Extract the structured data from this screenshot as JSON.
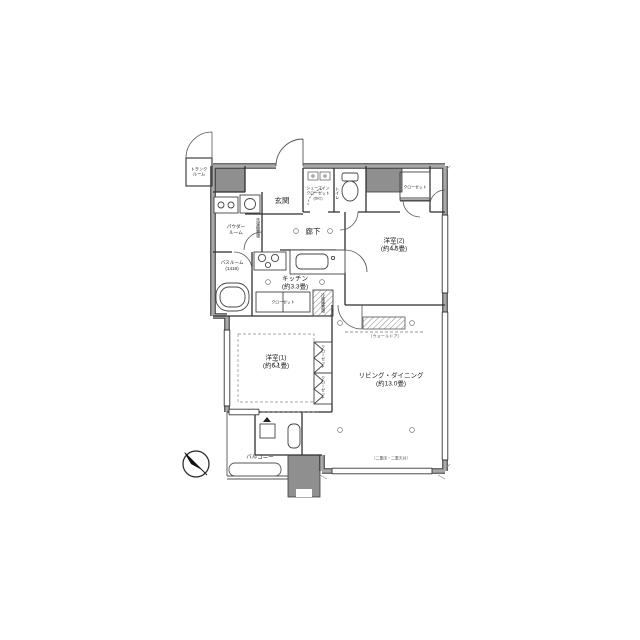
{
  "title": "マンション間取り図",
  "colors": {
    "wall_gray": "#9a9a9a",
    "wall_dark": "#3c3c3c",
    "meter_box_fill": "#8f8f8f",
    "text": "#1e1e1e",
    "note_text": "#5a5a5a",
    "background": "#ffffff"
  },
  "labels": {
    "trunk": "トランク\nルーム",
    "entrance": "玄関",
    "shoes_closet": "シューズイン\nクローゼット\n(SIC)",
    "toilet": "トイレ",
    "hallway": "廊下",
    "powder": "パウダー\nルーム",
    "washer": "洗濯機置場",
    "bath": "バスルーム\n(1418)",
    "kitchen": "キッチン\n(約3.3畳)",
    "kitchen_closet": "クローゼット",
    "fridge": "冷蔵庫置場",
    "bedroom2": "洋室(2)\n(約4.5畳)",
    "bedroom2_closet": "クローゼット",
    "bedroom1": "洋室(1)\n(約6.1畳)",
    "bedroom1_closet_a": "クローゼット",
    "bedroom1_closet_b": "クローゼット",
    "wall_door_note": "（ウォールドア）",
    "living": "リビング・ダイニング\n(約13.0畳)",
    "living_note": "（二重床・二重天井）",
    "balcony": "バルコニー"
  },
  "rooms": [
    {
      "name": "リビング・ダイニング",
      "size": "約13.0畳"
    },
    {
      "name": "洋室(1)",
      "size": "約6.1畳"
    },
    {
      "name": "洋室(2)",
      "size": "約4.5畳"
    },
    {
      "name": "キッチン",
      "size": "約3.3畳"
    },
    {
      "name": "バスルーム",
      "size": "1418"
    }
  ]
}
